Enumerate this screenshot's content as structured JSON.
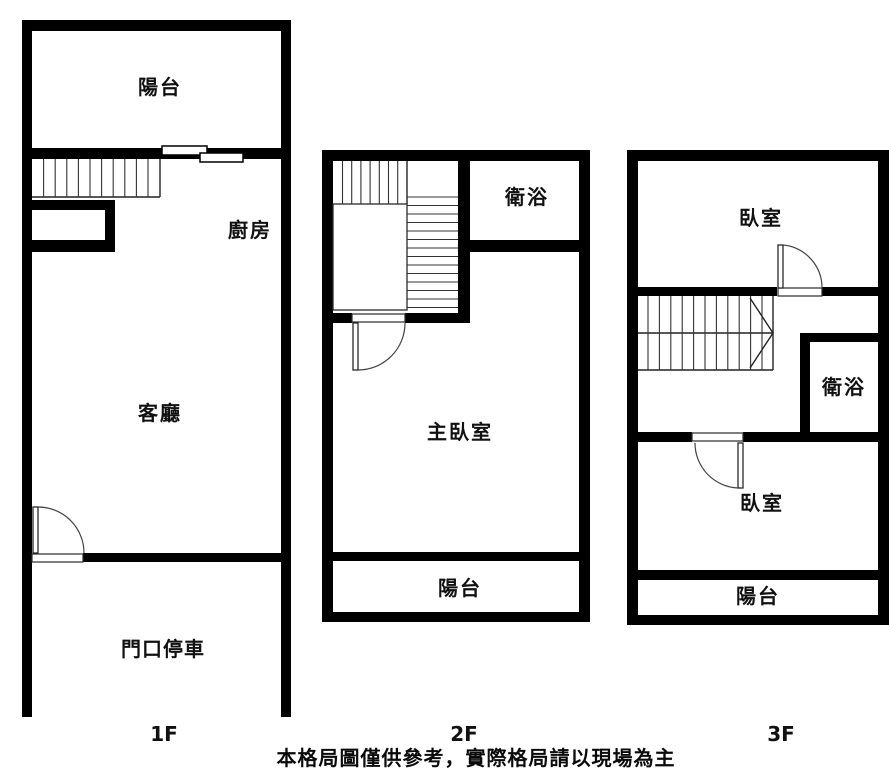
{
  "caption": "本格局圖僅供參考，實際格局請以現場為主",
  "colors": {
    "wall": "#000000",
    "background": "#ffffff",
    "text": "#111111"
  },
  "floors": {
    "f1": {
      "label": "1F",
      "rooms": {
        "balcony": "陽台",
        "kitchen": "廚房",
        "living_room": "客廳",
        "entry_parking": "門口停車"
      }
    },
    "f2": {
      "label": "2F",
      "rooms": {
        "bathroom": "衛浴",
        "master_bedroom": "主臥室",
        "balcony": "陽台"
      }
    },
    "f3": {
      "label": "3F",
      "rooms": {
        "bedroom_upper": "臥室",
        "bathroom": "衛浴",
        "bedroom_lower": "臥室",
        "balcony": "陽台"
      }
    }
  }
}
